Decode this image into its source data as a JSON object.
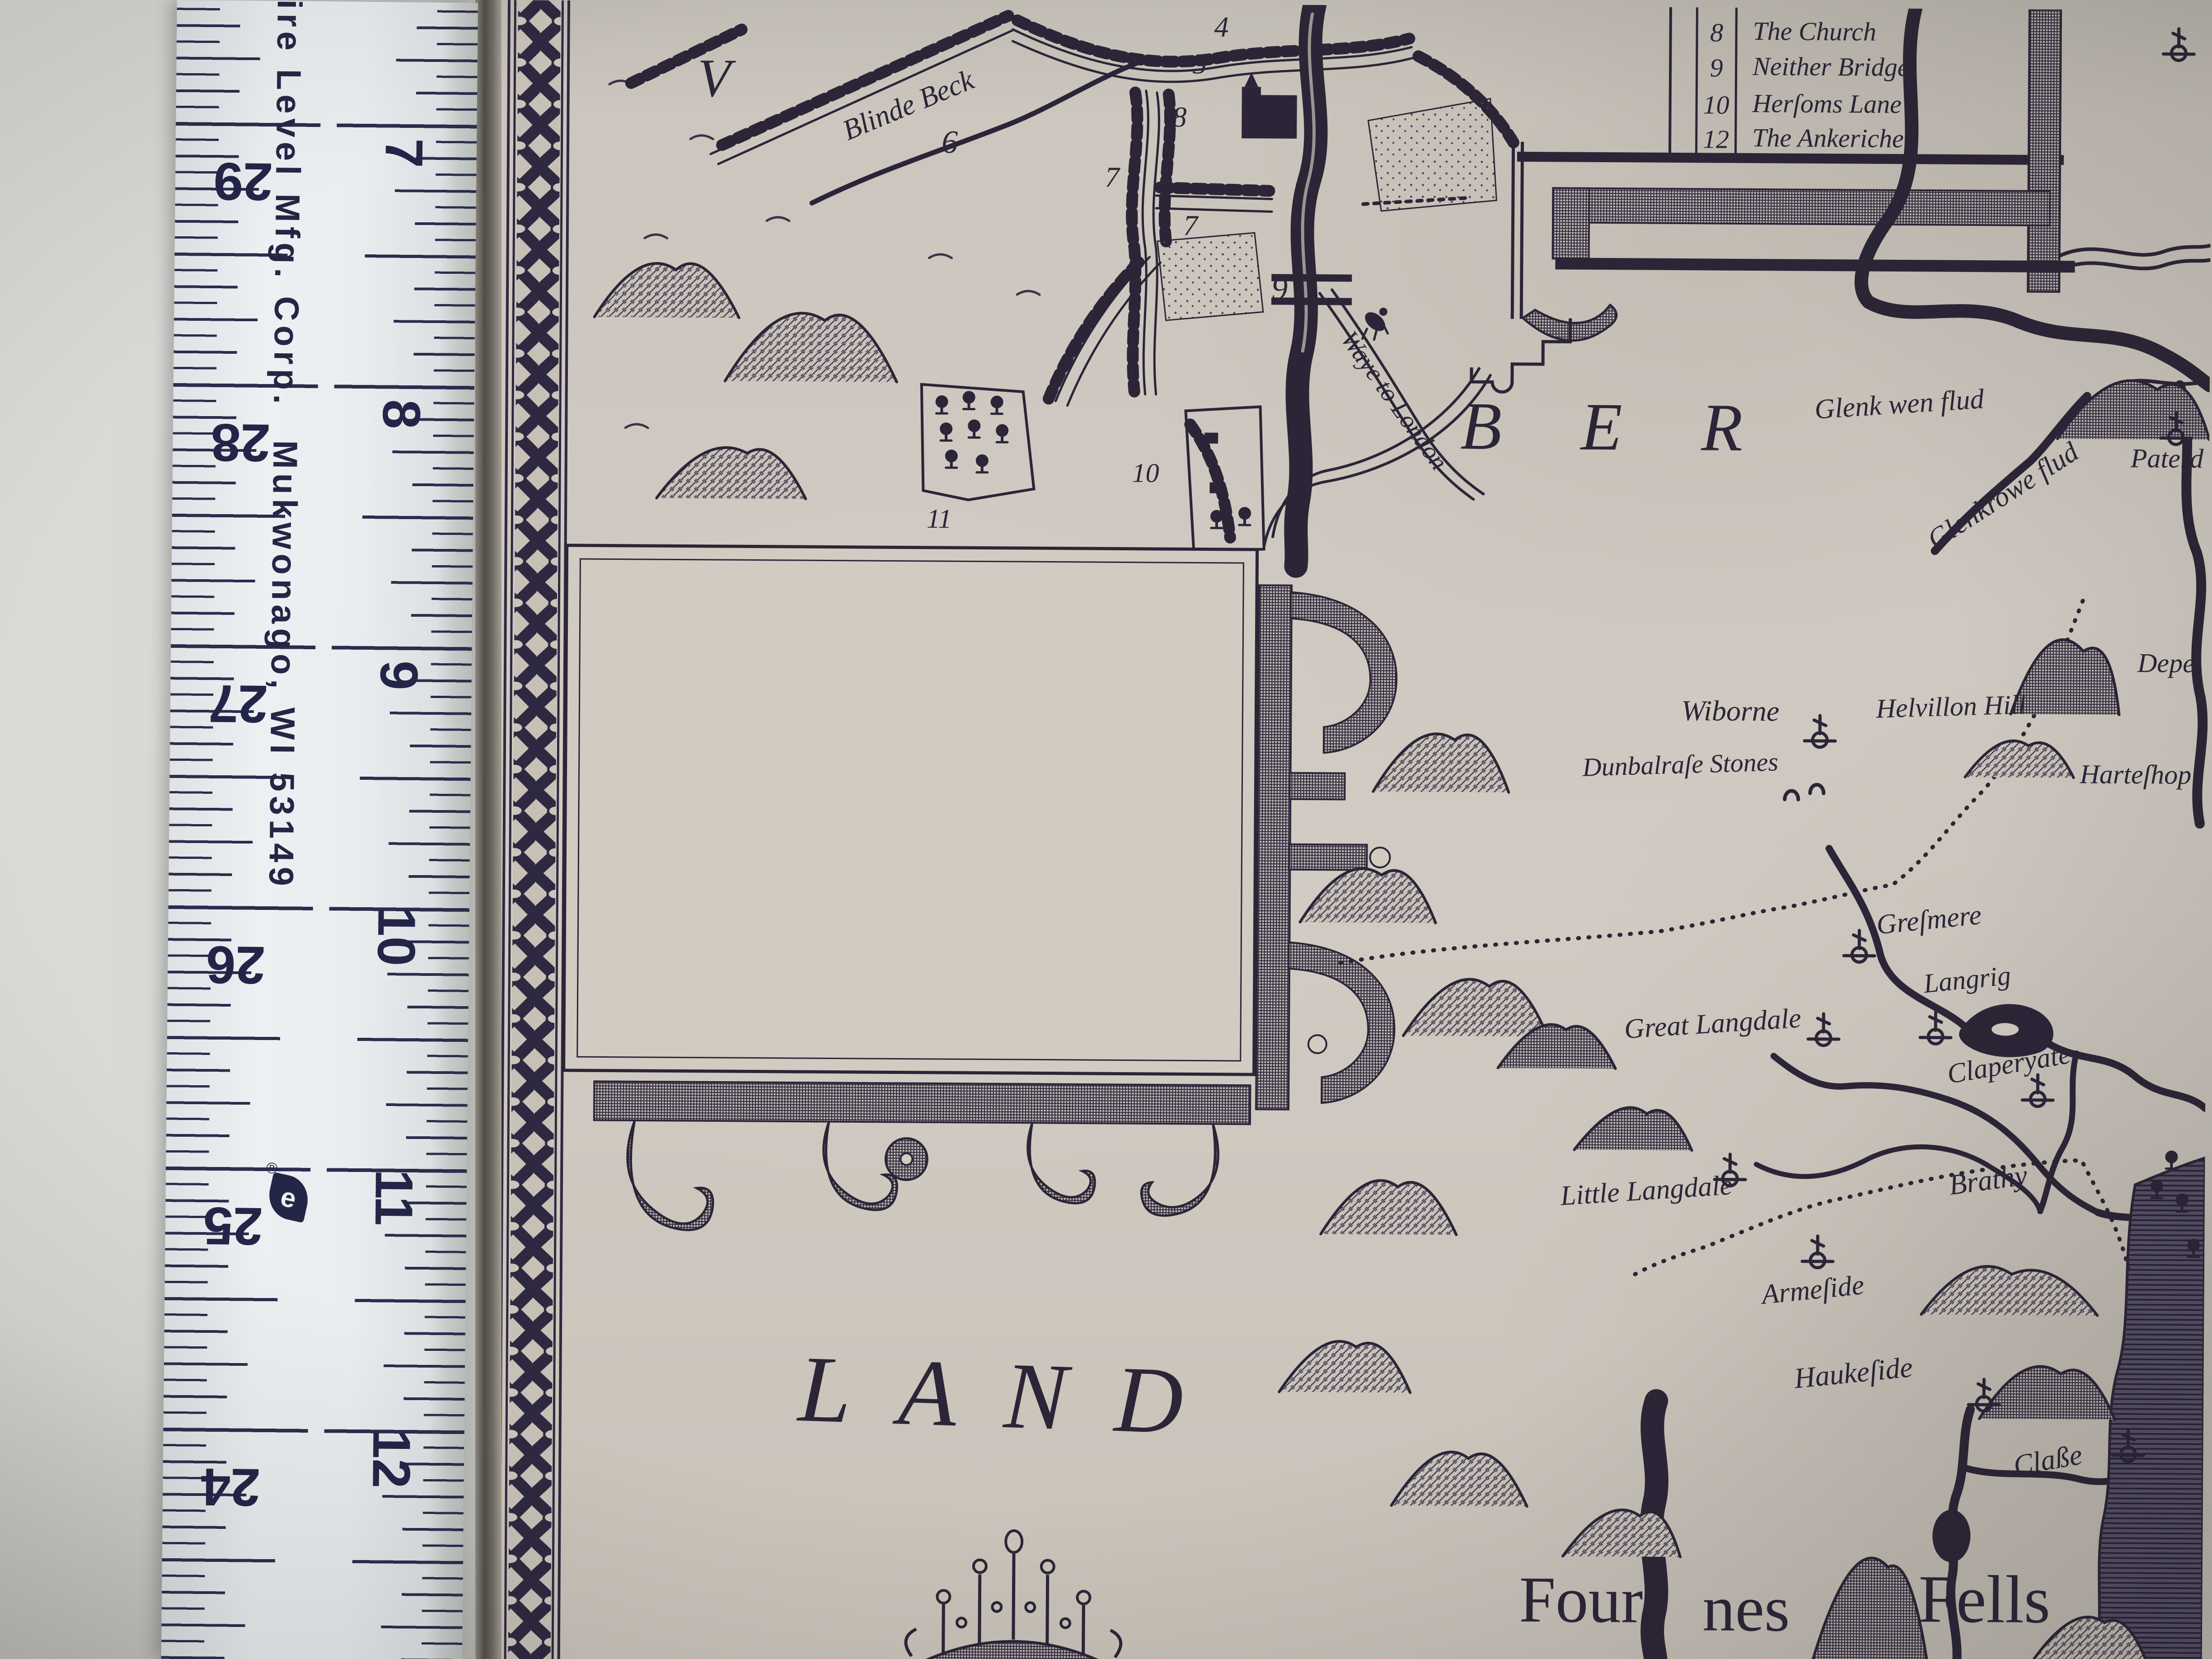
{
  "ruler": {
    "brand_line": "pire Level Mfg. Corp.",
    "brand_city": "Mukwonago, WI 53149",
    "logo_letter": "e",
    "registered_mark": "®",
    "left_scale": [
      "29",
      "28",
      "27",
      "26",
      "25",
      "24"
    ],
    "right_scale": [
      "7",
      "8",
      "9",
      "10",
      "11",
      "12"
    ]
  },
  "map": {
    "legend": {
      "rows": [
        {
          "num": "8",
          "name": "The Church"
        },
        {
          "num": "9",
          "name": "Neither Bridge"
        },
        {
          "num": "10",
          "name": "Herſoms Lane"
        },
        {
          "num": "12",
          "name": "The Ankeriche"
        }
      ]
    },
    "inset": {
      "letter_v": "V",
      "river": "Blinde Beck",
      "road": "Waye to London",
      "marks": [
        "4",
        "5",
        "6",
        "7",
        "7",
        "8",
        "9",
        "10",
        "11"
      ]
    },
    "county": {
      "big1": "BER",
      "big2": "LAND",
      "fells": [
        "Four",
        "nes",
        "Fells"
      ],
      "places": [
        {
          "name": "Glenk wen flud"
        },
        {
          "name": "Glenkrowe flud"
        },
        {
          "name": "Paterd"
        },
        {
          "name": "Depe"
        },
        {
          "name": "Harteſhop"
        },
        {
          "name": "Wiborne"
        },
        {
          "name": "Helvillon Hill"
        },
        {
          "name": "Dunbalraſe Stones"
        },
        {
          "name": "Greſmere"
        },
        {
          "name": "Langrig"
        },
        {
          "name": "Great Langdale"
        },
        {
          "name": "Claperyate"
        },
        {
          "name": "Little Langdale"
        },
        {
          "name": "Brathy"
        },
        {
          "name": "Armeſide"
        },
        {
          "name": "Haukeſide"
        },
        {
          "name": "Claße"
        }
      ]
    }
  }
}
